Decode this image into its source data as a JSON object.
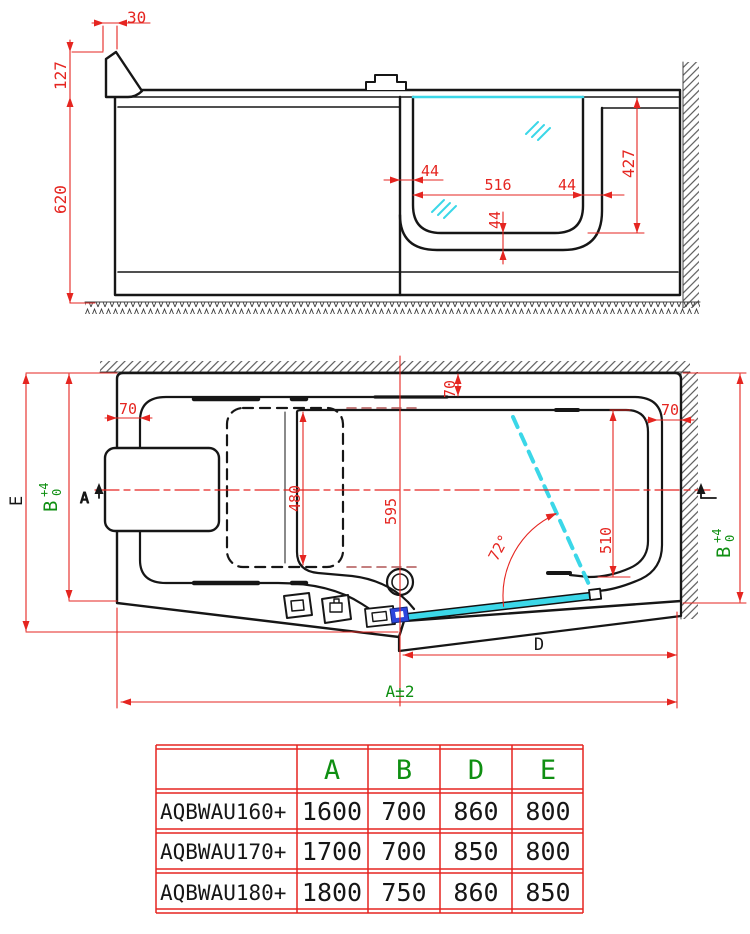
{
  "drawing": {
    "side_view": {
      "dim_top_offset": "30",
      "dim_rim_height": "127",
      "dim_body_height": "620",
      "dim_wall_left": "44",
      "dim_seat_width": "516",
      "dim_wall_right": "44",
      "dim_bottom_thickness": "44",
      "dim_inner_depth": "427"
    },
    "plan_view": {
      "dim_rim_left": "70",
      "dim_rim_top": "70",
      "dim_rim_right": "70",
      "dim_seat_length": "480",
      "dim_drain_offset": "595",
      "dim_door_clear": "510",
      "dim_door_angle": "72°",
      "dim_length_label": "A±2",
      "dim_width_label_e": "E",
      "dim_door_label": "D",
      "dim_b": {
        "letter": "B",
        "plus": "+4",
        "zero": "0"
      },
      "section_marker": "A"
    },
    "table": {
      "col_headers": [
        "A",
        "B",
        "D",
        "E"
      ],
      "rows": [
        {
          "model": "AQBWAU160+",
          "a": "1600",
          "b": "700",
          "d": "860",
          "e": "800"
        },
        {
          "model": "AQBWAU170+",
          "a": "1700",
          "b": "700",
          "d": "850",
          "e": "800"
        },
        {
          "model": "AQBWAU180+",
          "a": "1800",
          "b": "750",
          "d": "860",
          "e": "850"
        }
      ]
    },
    "colors": {
      "dimension_red": "#e52520",
      "label_green": "#0f8f12",
      "water_cyan": "#3bd7e8",
      "handle_blue": "#2b46dd",
      "line_black": "#161616"
    }
  }
}
